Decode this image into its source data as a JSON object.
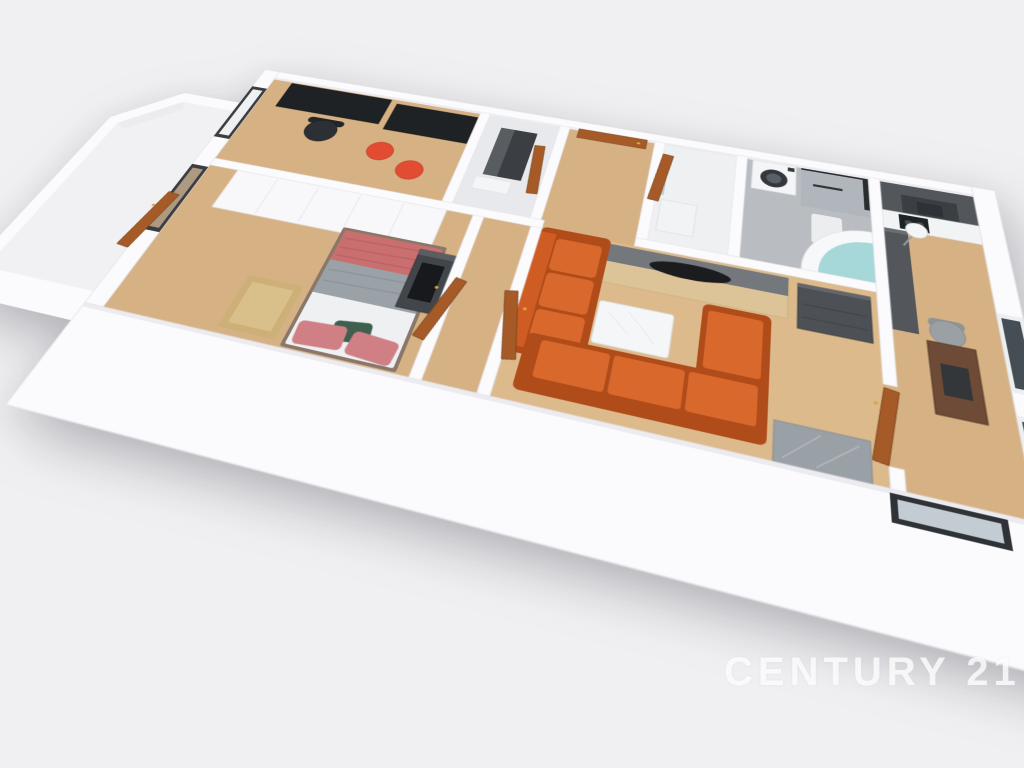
{
  "watermark": {
    "text": "CENTURY 21"
  },
  "scene": {
    "type": "3d-floor-plan-render",
    "description": "Aerial 3D cutaway render of an apartment floor plan on a light gray background",
    "rooms": [
      {
        "name": "office",
        "furniture": [
          "desk",
          "desk",
          "office-chair",
          "red-armchair",
          "red-armchair",
          "window"
        ]
      },
      {
        "name": "bedroom",
        "furniture": [
          "wardrobe",
          "double-bed",
          "dresser-with-tv",
          "gold-rug",
          "window",
          "entry-door"
        ]
      },
      {
        "name": "shower-room",
        "furniture": [
          "shower-column",
          "bench",
          "door"
        ]
      },
      {
        "name": "entry-hall",
        "furniture": [
          "front-door"
        ]
      },
      {
        "name": "wc",
        "furniture": [
          "washbasin-cabinet",
          "door"
        ]
      },
      {
        "name": "bathroom",
        "furniture": [
          "washing-machine",
          "glass-shower",
          "corner-bathtub",
          "bath-mat"
        ]
      },
      {
        "name": "kitchen",
        "furniture": [
          "tall-cabinets",
          "cooker-hood",
          "counter-with-hob",
          "side-counter",
          "floor-lamp",
          "dining-table",
          "gray-chair",
          "window",
          "window"
        ]
      },
      {
        "name": "living-room",
        "furniture": [
          "three-seat-sofa",
          "corner-sofa",
          "coffee-table",
          "tv-stand",
          "dark-sideboard",
          "marble-console",
          "door-to-kitchen",
          "door-to-hall"
        ]
      },
      {
        "name": "balcony-bay",
        "furniture": []
      }
    ],
    "colors": {
      "background": "#f0f0f2",
      "wall": "#fbfbfd",
      "wall_shade": "#ebebf0",
      "floor_wood": "#d6b184",
      "floor_wood_light": "#dcba8c",
      "floor_tile": "#b9bdc2",
      "floor_marble": "#e8e9ec",
      "floor_wc": "#eef0f2",
      "bay_floor": "#f1f1f4",
      "sofa_orange": "#cf5c22",
      "sofa_orange_light": "#d8682c",
      "sofa_orange_dark": "#b04c1a",
      "armchair_red": "#e14c33",
      "door_brown": "#a55a28",
      "desk_black": "#1f2224",
      "chair_black": "#2c2f33",
      "wardrobe_white": "#f8f8fa",
      "duvet_rose": "#c96f6f",
      "duvet_gray": "#9aa1a7",
      "sheet_white": "#eef0f2",
      "pillow_pink": "#d08084",
      "pillow_green": "#40604f",
      "dresser_dark": "#42464a",
      "tv_stand_wood": "#dcc398",
      "tv_stand_top": "#74787c",
      "cabinet_dark": "#4d5155",
      "kitchen_dark": "#53575b",
      "kitchen_hood": "#3b3f43",
      "counter_white": "#f2f3f5",
      "hob_black": "#1f2225",
      "washer_white": "#f3f5f6",
      "tub_white": "#f6f8f9",
      "tub_water": "#a6d7d9",
      "table_walnut": "#6e4b36",
      "chair_gray": "#9ba0a5",
      "rug_gold": "#ccb077",
      "window_frame": "#3a3e42",
      "window_glass_dark": "#454e54",
      "window_glass_reflect": "#ae9a80",
      "console_gray": "#9aa1a6",
      "lamp_white": "#f4f5f7"
    }
  }
}
